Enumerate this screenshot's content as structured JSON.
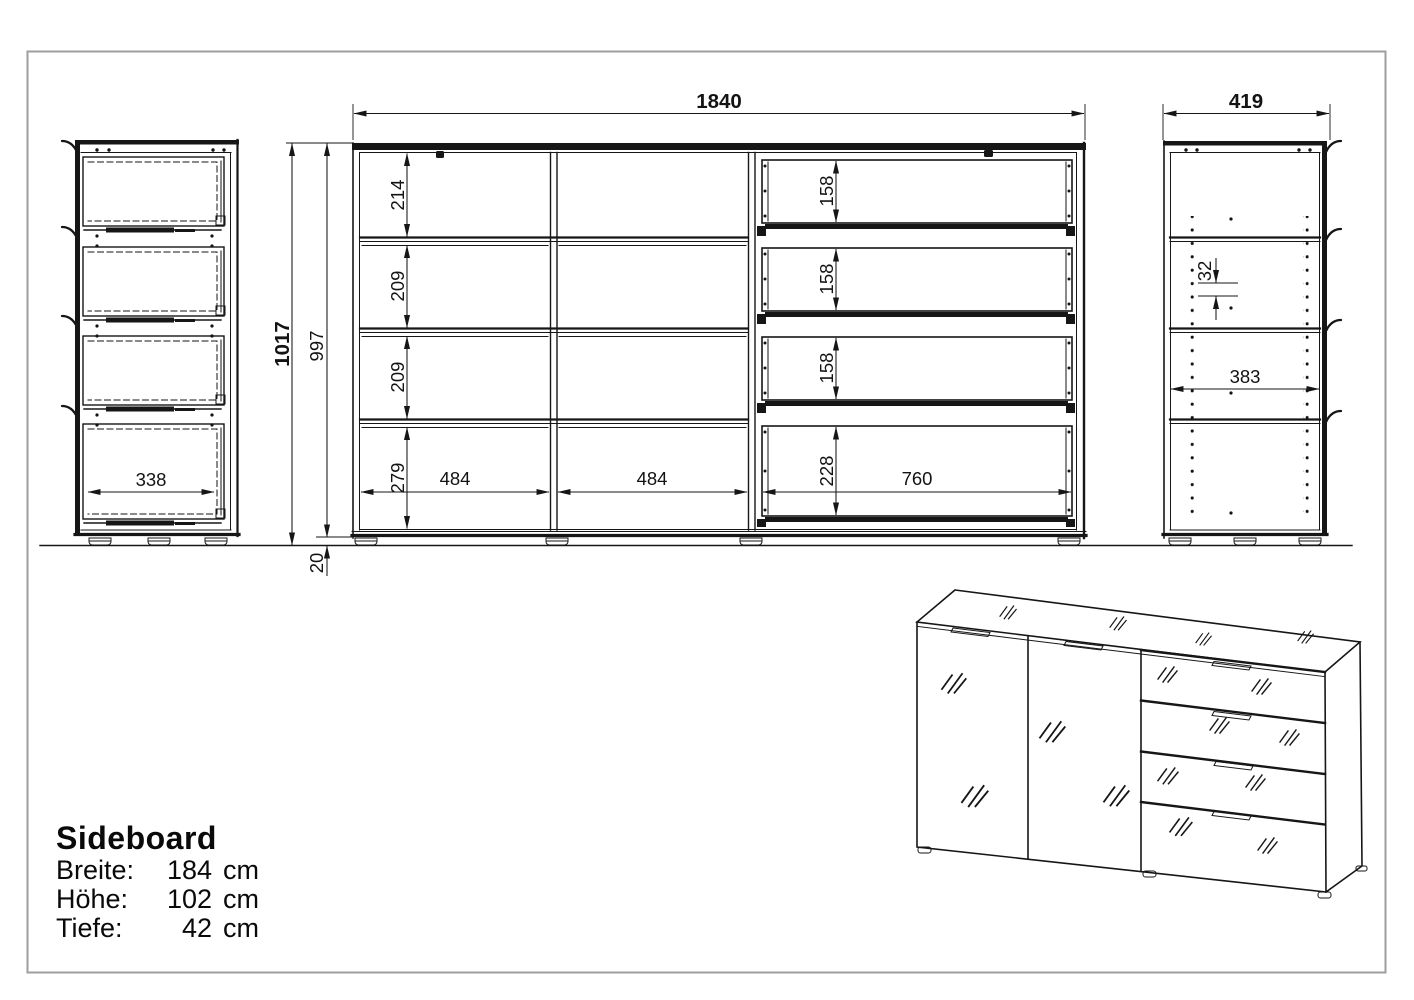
{
  "product": {
    "title": "Sideboard",
    "specs": [
      {
        "label": "Breite:",
        "value": "184",
        "unit": "cm"
      },
      {
        "label": "Höhe:",
        "value": "102",
        "unit": "cm"
      },
      {
        "label": "Tiefe:",
        "value": "42",
        "unit": "cm"
      }
    ]
  },
  "views": {
    "left_side": {
      "drawer_inner_width": "338"
    },
    "front": {
      "total_width": "1840",
      "total_height": "1017",
      "body_height": "997",
      "foot_height": "20",
      "compartment_heights": [
        "214",
        "209",
        "209",
        "279"
      ],
      "drawer_front_heights": [
        "158",
        "158",
        "158",
        "228"
      ],
      "compartment_widths": [
        "484",
        "484",
        "760"
      ]
    },
    "right_side": {
      "depth": "419",
      "hole_pitch": "32",
      "inner_depth": "383"
    }
  }
}
